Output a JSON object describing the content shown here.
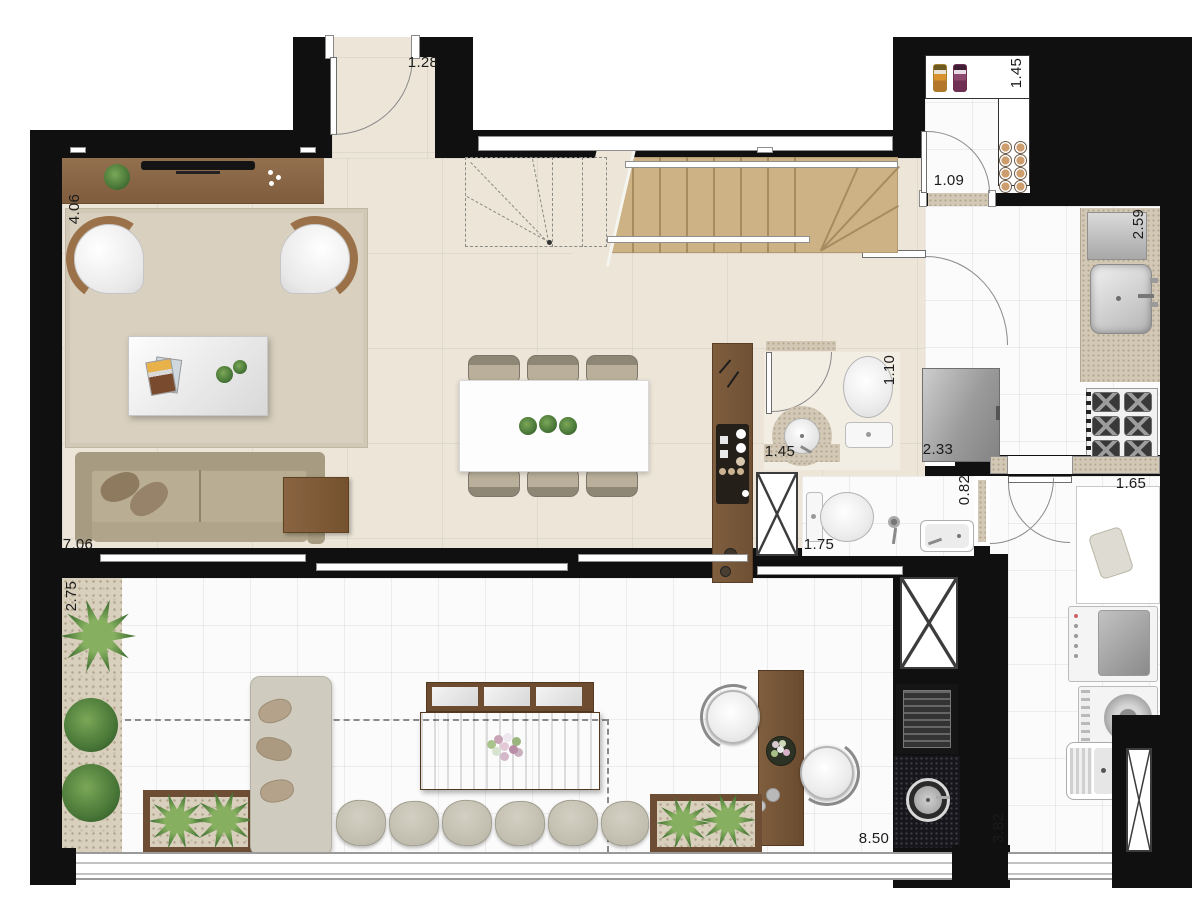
{
  "plan_type": "residential-apartment-floor-plan",
  "dimensions": {
    "entry_door_width": "1.28",
    "living_room_width": "4.06",
    "living_room_length": "7.06",
    "terrace_depth": "2.75",
    "pantry_width": "1.45",
    "pantry_door_width": "1.09",
    "kitchen_counter_length": "2.59",
    "lavabo_length": "1.10",
    "lavabo_width": "1.45",
    "refrigerator_niche_width": "2.33",
    "bathroom_length": "1.75",
    "bathroom_door_width": "0.82",
    "service_counter_length": "1.65",
    "terrace_width": "8.50",
    "service_area_length": "3.82"
  },
  "colors": {
    "wall": "#101010",
    "social_floor": "#ece5d8",
    "wet_floor": "#fbfbfb",
    "stair_wood": "#cdb285",
    "furniture_wood": "#8b6a4a",
    "granite": "#d3c8b5",
    "granite_dark": "#17171b",
    "plant_green": "#4a7a38",
    "sofa_beige": "#b9ae93"
  }
}
